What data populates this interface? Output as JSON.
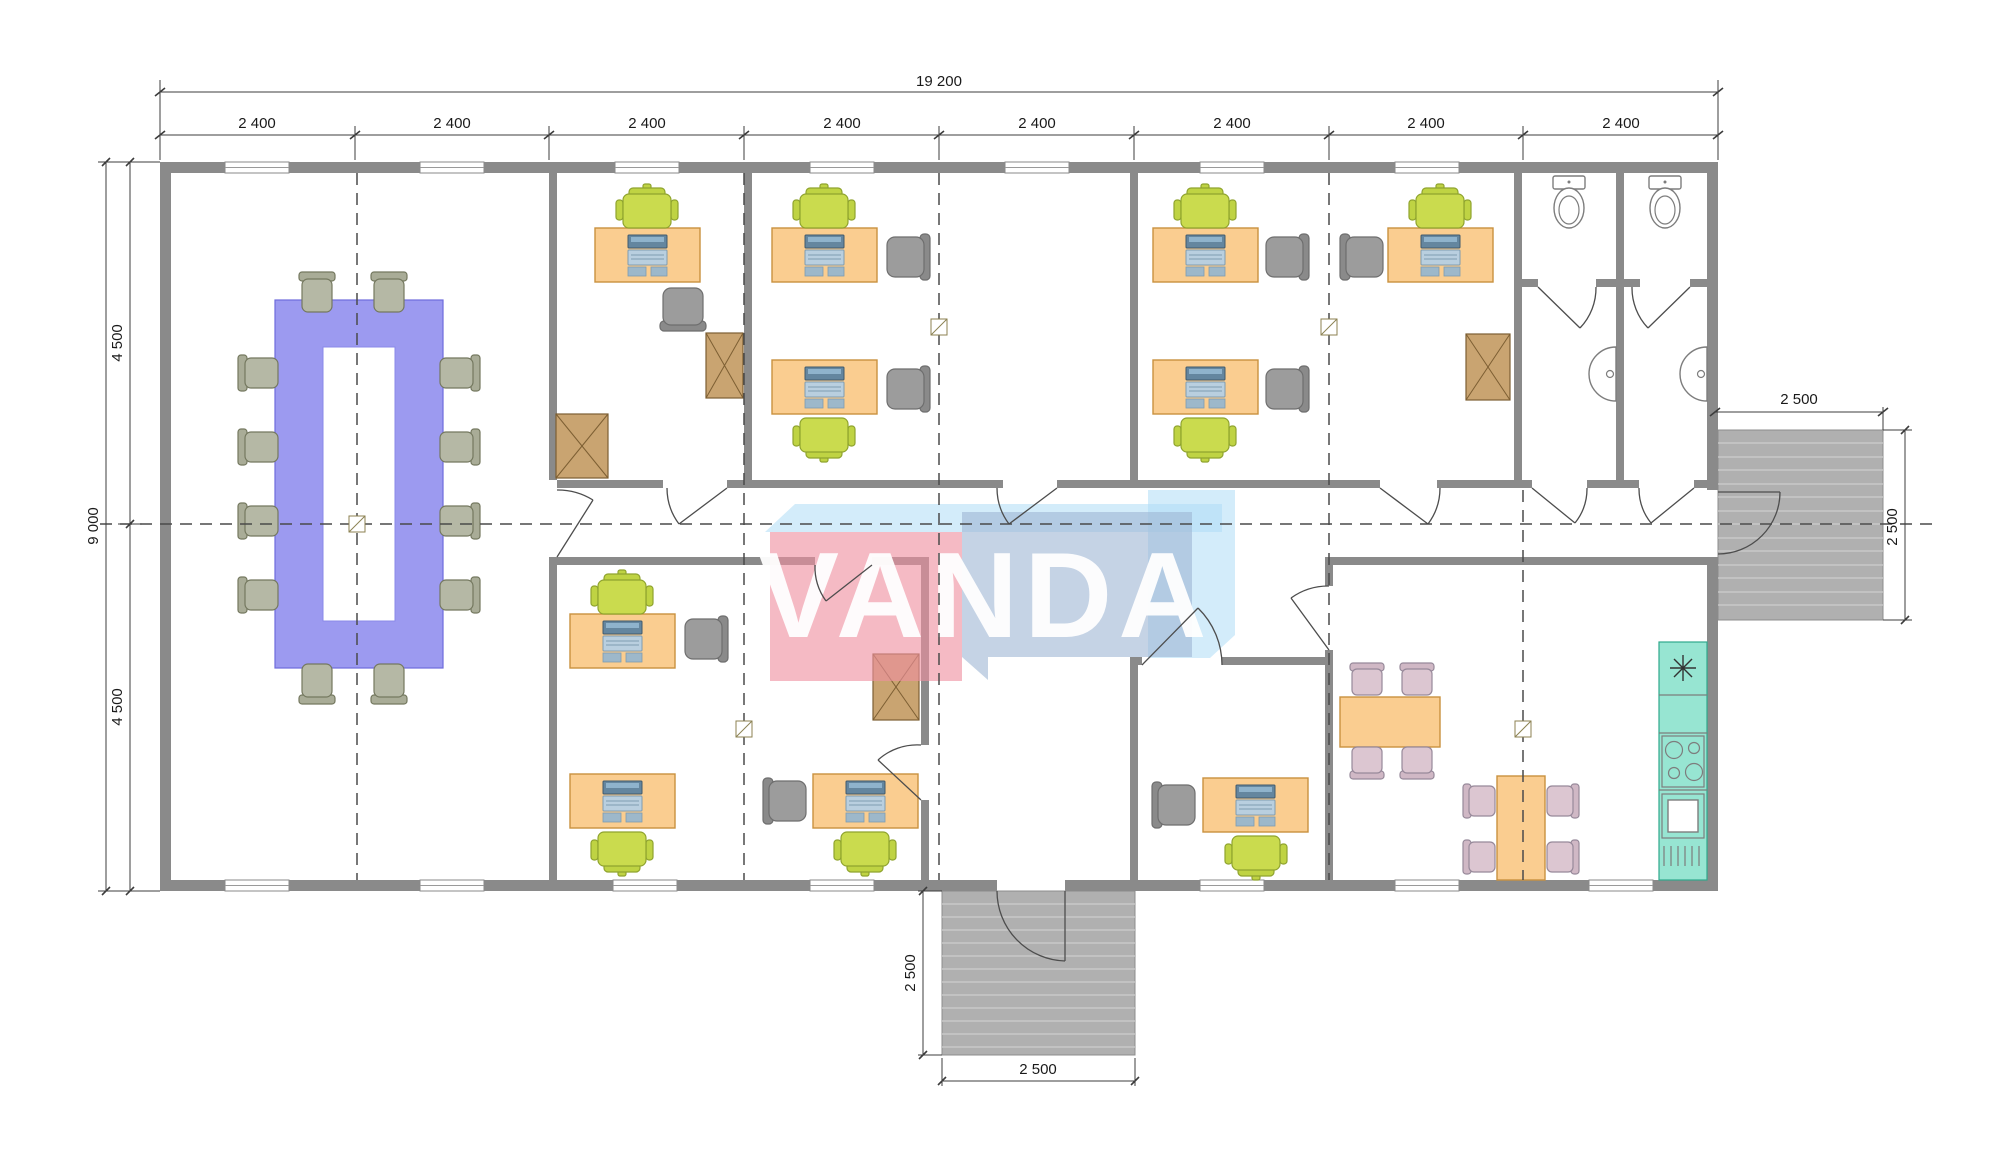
{
  "watermark": {
    "text": "VANDA"
  },
  "dimensions": {
    "overall_width": "19 200",
    "bays": [
      "2 400",
      "2 400",
      "2 400",
      "2 400",
      "2 400",
      "2 400",
      "2 400",
      "2 400"
    ],
    "overall_height": "9 000",
    "left_upper_half": "4 500",
    "left_lower_half": "4 500",
    "right_stairs_width": "2 500",
    "right_stairs_depth": "2 500",
    "bottom_stairs_depth": "2 500",
    "bottom_stairs_width": "2 500"
  },
  "colors": {
    "wall": "#8a8a8a",
    "desk": "#facd90",
    "desk_border": "#c9913f",
    "chair_green": "#cadb4e",
    "chair_gray": "#9c9c9c",
    "meeting_table": "#9c9af0",
    "meeting_chair": "#b5b8a5",
    "cabinet": "#c9a471",
    "dining_chair": "#dcc6d1",
    "counter": "#97e5d2",
    "stairs": "#b0b0b0",
    "logo_pink": "#ef8fa0",
    "logo_blue": "#9fb6d4",
    "logo_lightblue": "#aedcf5",
    "dim_text": "#1a1a1a"
  }
}
